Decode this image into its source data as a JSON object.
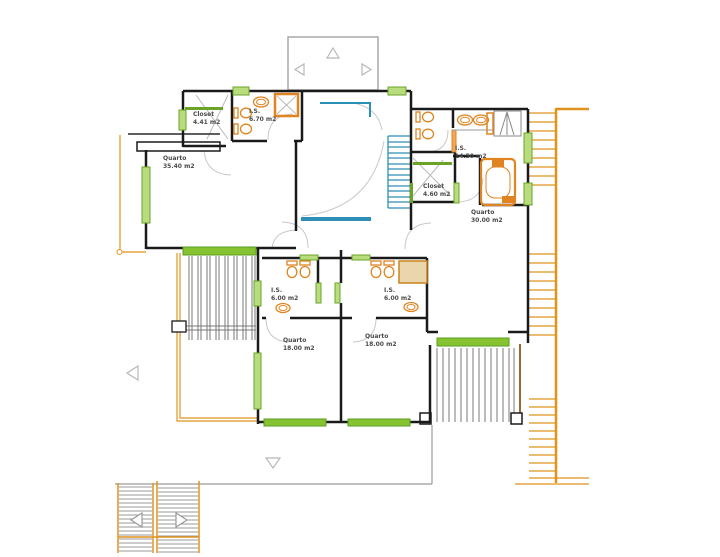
{
  "drawing": {
    "title": "floor-plan-upper-level",
    "rooms": [
      {
        "id": "closet-upper-left",
        "name": "Closet",
        "area": "4.41 m2"
      },
      {
        "id": "is-upper-left",
        "name": "I.S.",
        "area": "6.70 m2"
      },
      {
        "id": "quarto-left",
        "name": "Quarto",
        "area": "35.40 m2"
      },
      {
        "id": "is-right",
        "name": "I.S.",
        "area": "14.50 m2"
      },
      {
        "id": "closet-right",
        "name": "Closet",
        "area": "4.60 m2"
      },
      {
        "id": "quarto-right",
        "name": "Quarto",
        "area": "30.00 m2"
      },
      {
        "id": "is-mid-left",
        "name": "I.S.",
        "area": "6.00 m2"
      },
      {
        "id": "is-mid-right",
        "name": "I.S.",
        "area": "6.00 m2"
      },
      {
        "id": "quarto-bottom-left",
        "name": "Quarto",
        "area": "18.00 m2"
      },
      {
        "id": "quarto-bottom-right",
        "name": "Quarto",
        "area": "18.00 m2"
      }
    ],
    "colors": {
      "walls": "#1a1a1a",
      "windows_frame": "#6aa427",
      "windows_fill": "#b9dc7e",
      "window_band": "#86c232",
      "fixtures": "#df8420",
      "deck_trellis": "#e0921f",
      "deck_edge_dark": "#9b6a33",
      "stairs_blue": "#2d8fb5",
      "detail_gray": "#9a9a9a",
      "shower_fill": "#ead6ad",
      "label_text": "#4a4a4a"
    }
  }
}
